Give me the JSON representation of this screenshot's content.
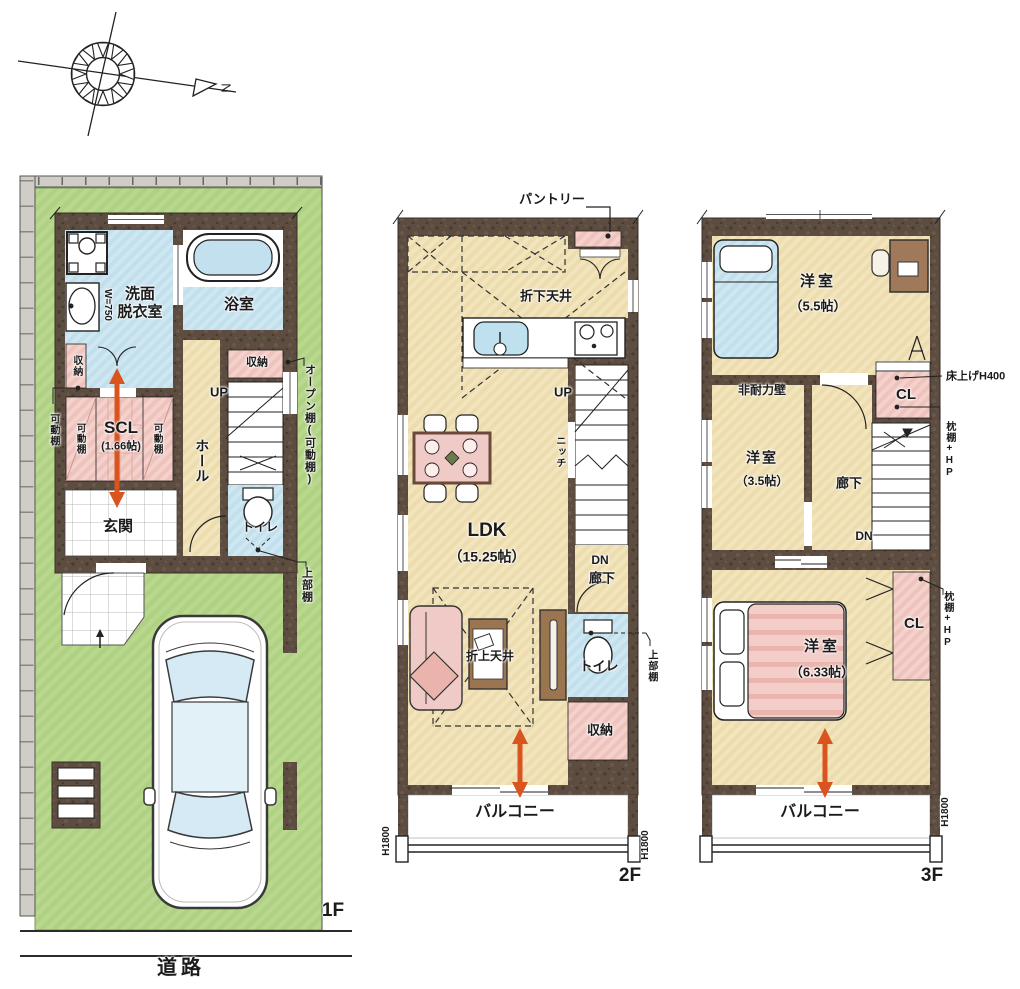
{
  "colors": {
    "wall": "#5d4c40",
    "floor_tan": "#f2e4bc",
    "water_blue": "#cfe7f2",
    "closet_pink": "#f5d1cc",
    "lot_green": "#b9d88e",
    "arrow_orange": "#d9541e"
  },
  "compass": {
    "north": "N"
  },
  "site": {
    "road": "道路"
  },
  "f1": {
    "label": "1F",
    "senmen": "洗面\n脱衣室",
    "bath": "浴室",
    "w750": "W=750",
    "shuno_left": "収納",
    "kadodana": "可動棚",
    "kadodana_l": "可動棚",
    "kadodana_r": "可動棚",
    "scl_title": "SCL",
    "scl_size": "(1.66帖)",
    "hall": "ホール",
    "up": "UP",
    "shuno_stair": "収納",
    "open_shelf": "オープン棚(可動棚)",
    "toilet": "トイレ",
    "genkan": "玄関",
    "jobudana": "上部棚"
  },
  "f2": {
    "label": "2F",
    "pantry": "パントリー",
    "orishita": "折下天井",
    "up": "UP",
    "niche": "ニッチ",
    "ldk_title": "LDK",
    "ldk_size": "（15.25帖）",
    "dn": "DN",
    "rouka": "廊下",
    "oriage": "折上天井",
    "toilet": "トイレ",
    "jobudana": "上部棚",
    "shuno": "収納",
    "balcony": "バルコニー",
    "h1800_l": "H1800",
    "h1800_r": "H1800"
  },
  "f3": {
    "label": "3F",
    "room55_title": "洋室",
    "room55_size": "（5.5帖）",
    "hitairyoku": "非耐力壁",
    "room35_title": "洋室",
    "room35_size": "（3.5帖）",
    "rouka": "廊下",
    "cl_upper": "CL",
    "yukaage": "床上げH400",
    "makura_upper": "枕棚+HP",
    "dn": "DN",
    "room633_title": "洋室",
    "room633_size": "（6.33帖）",
    "cl_lower": "CL",
    "makura_lower": "枕棚+HP",
    "balcony": "バルコニー",
    "h1800": "H1800"
  }
}
